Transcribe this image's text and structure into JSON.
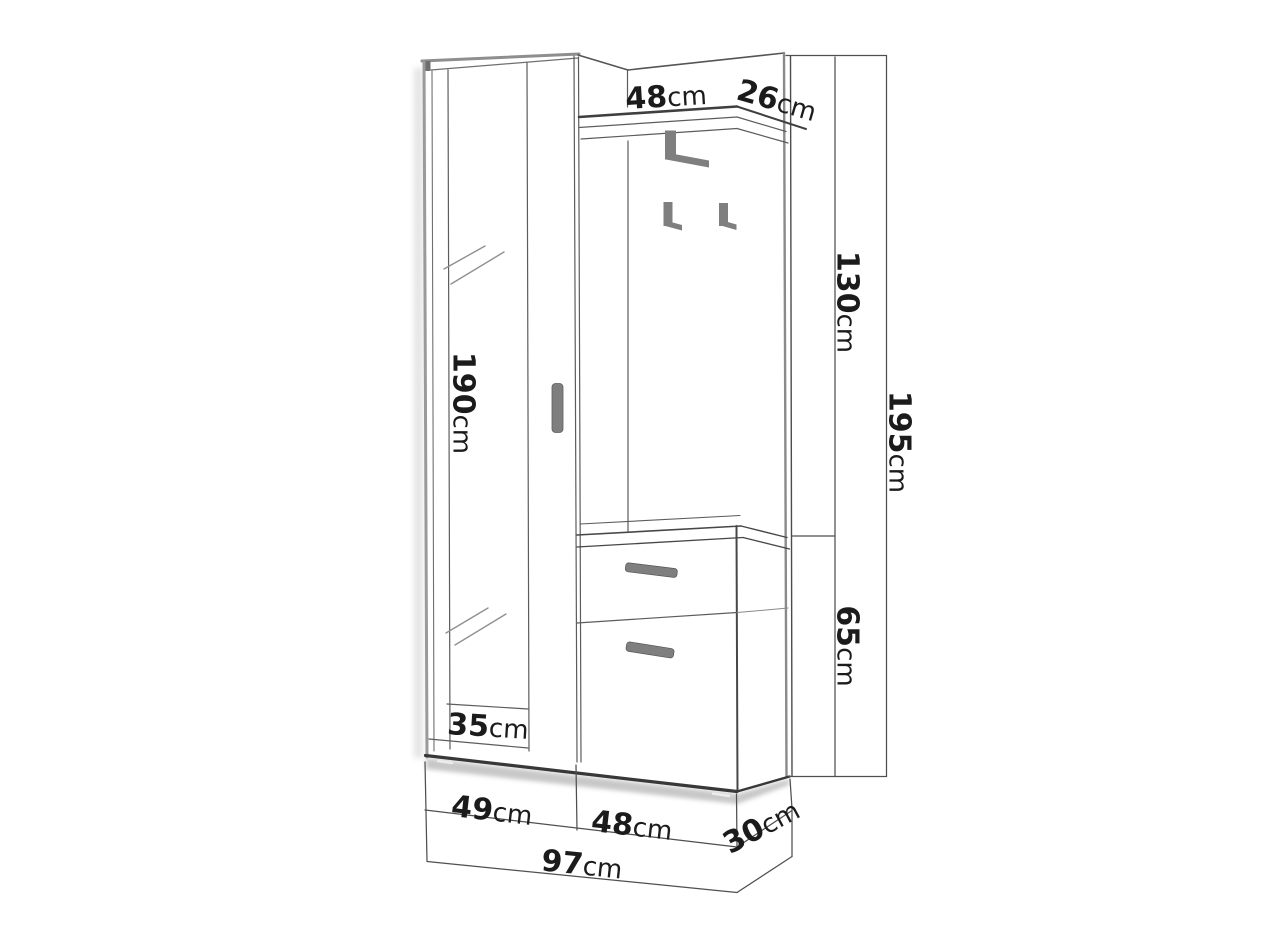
{
  "diagram": {
    "type": "furniture-dimension-drawing",
    "subject": "hallway wardrobe set with mirror, coat hook panel, shelf and shoe cabinet"
  },
  "dimensions": {
    "shelf_width": {
      "value": "48",
      "unit": "cm"
    },
    "shelf_depth": {
      "value": "26",
      "unit": "cm"
    },
    "mirror_door_height": {
      "value": "190",
      "unit": "cm"
    },
    "hook_panel_height": {
      "value": "130",
      "unit": "cm"
    },
    "total_height": {
      "value": "195",
      "unit": "cm"
    },
    "cabinet_height": {
      "value": "65",
      "unit": "cm"
    },
    "wardrobe_depth": {
      "value": "35",
      "unit": "cm"
    },
    "wardrobe_width": {
      "value": "49",
      "unit": "cm"
    },
    "cabinet_width": {
      "value": "48",
      "unit": "cm"
    },
    "cabinet_depth": {
      "value": "30",
      "unit": "cm"
    },
    "total_width": {
      "value": "97",
      "unit": "cm"
    }
  },
  "colors": {
    "background": "#ffffff",
    "line": "#4a4a4a",
    "line_soft": "#8e8e8e",
    "text": "#1b1b1b",
    "handle": "#7f7f7f",
    "shadow": "#b5b5b5"
  }
}
